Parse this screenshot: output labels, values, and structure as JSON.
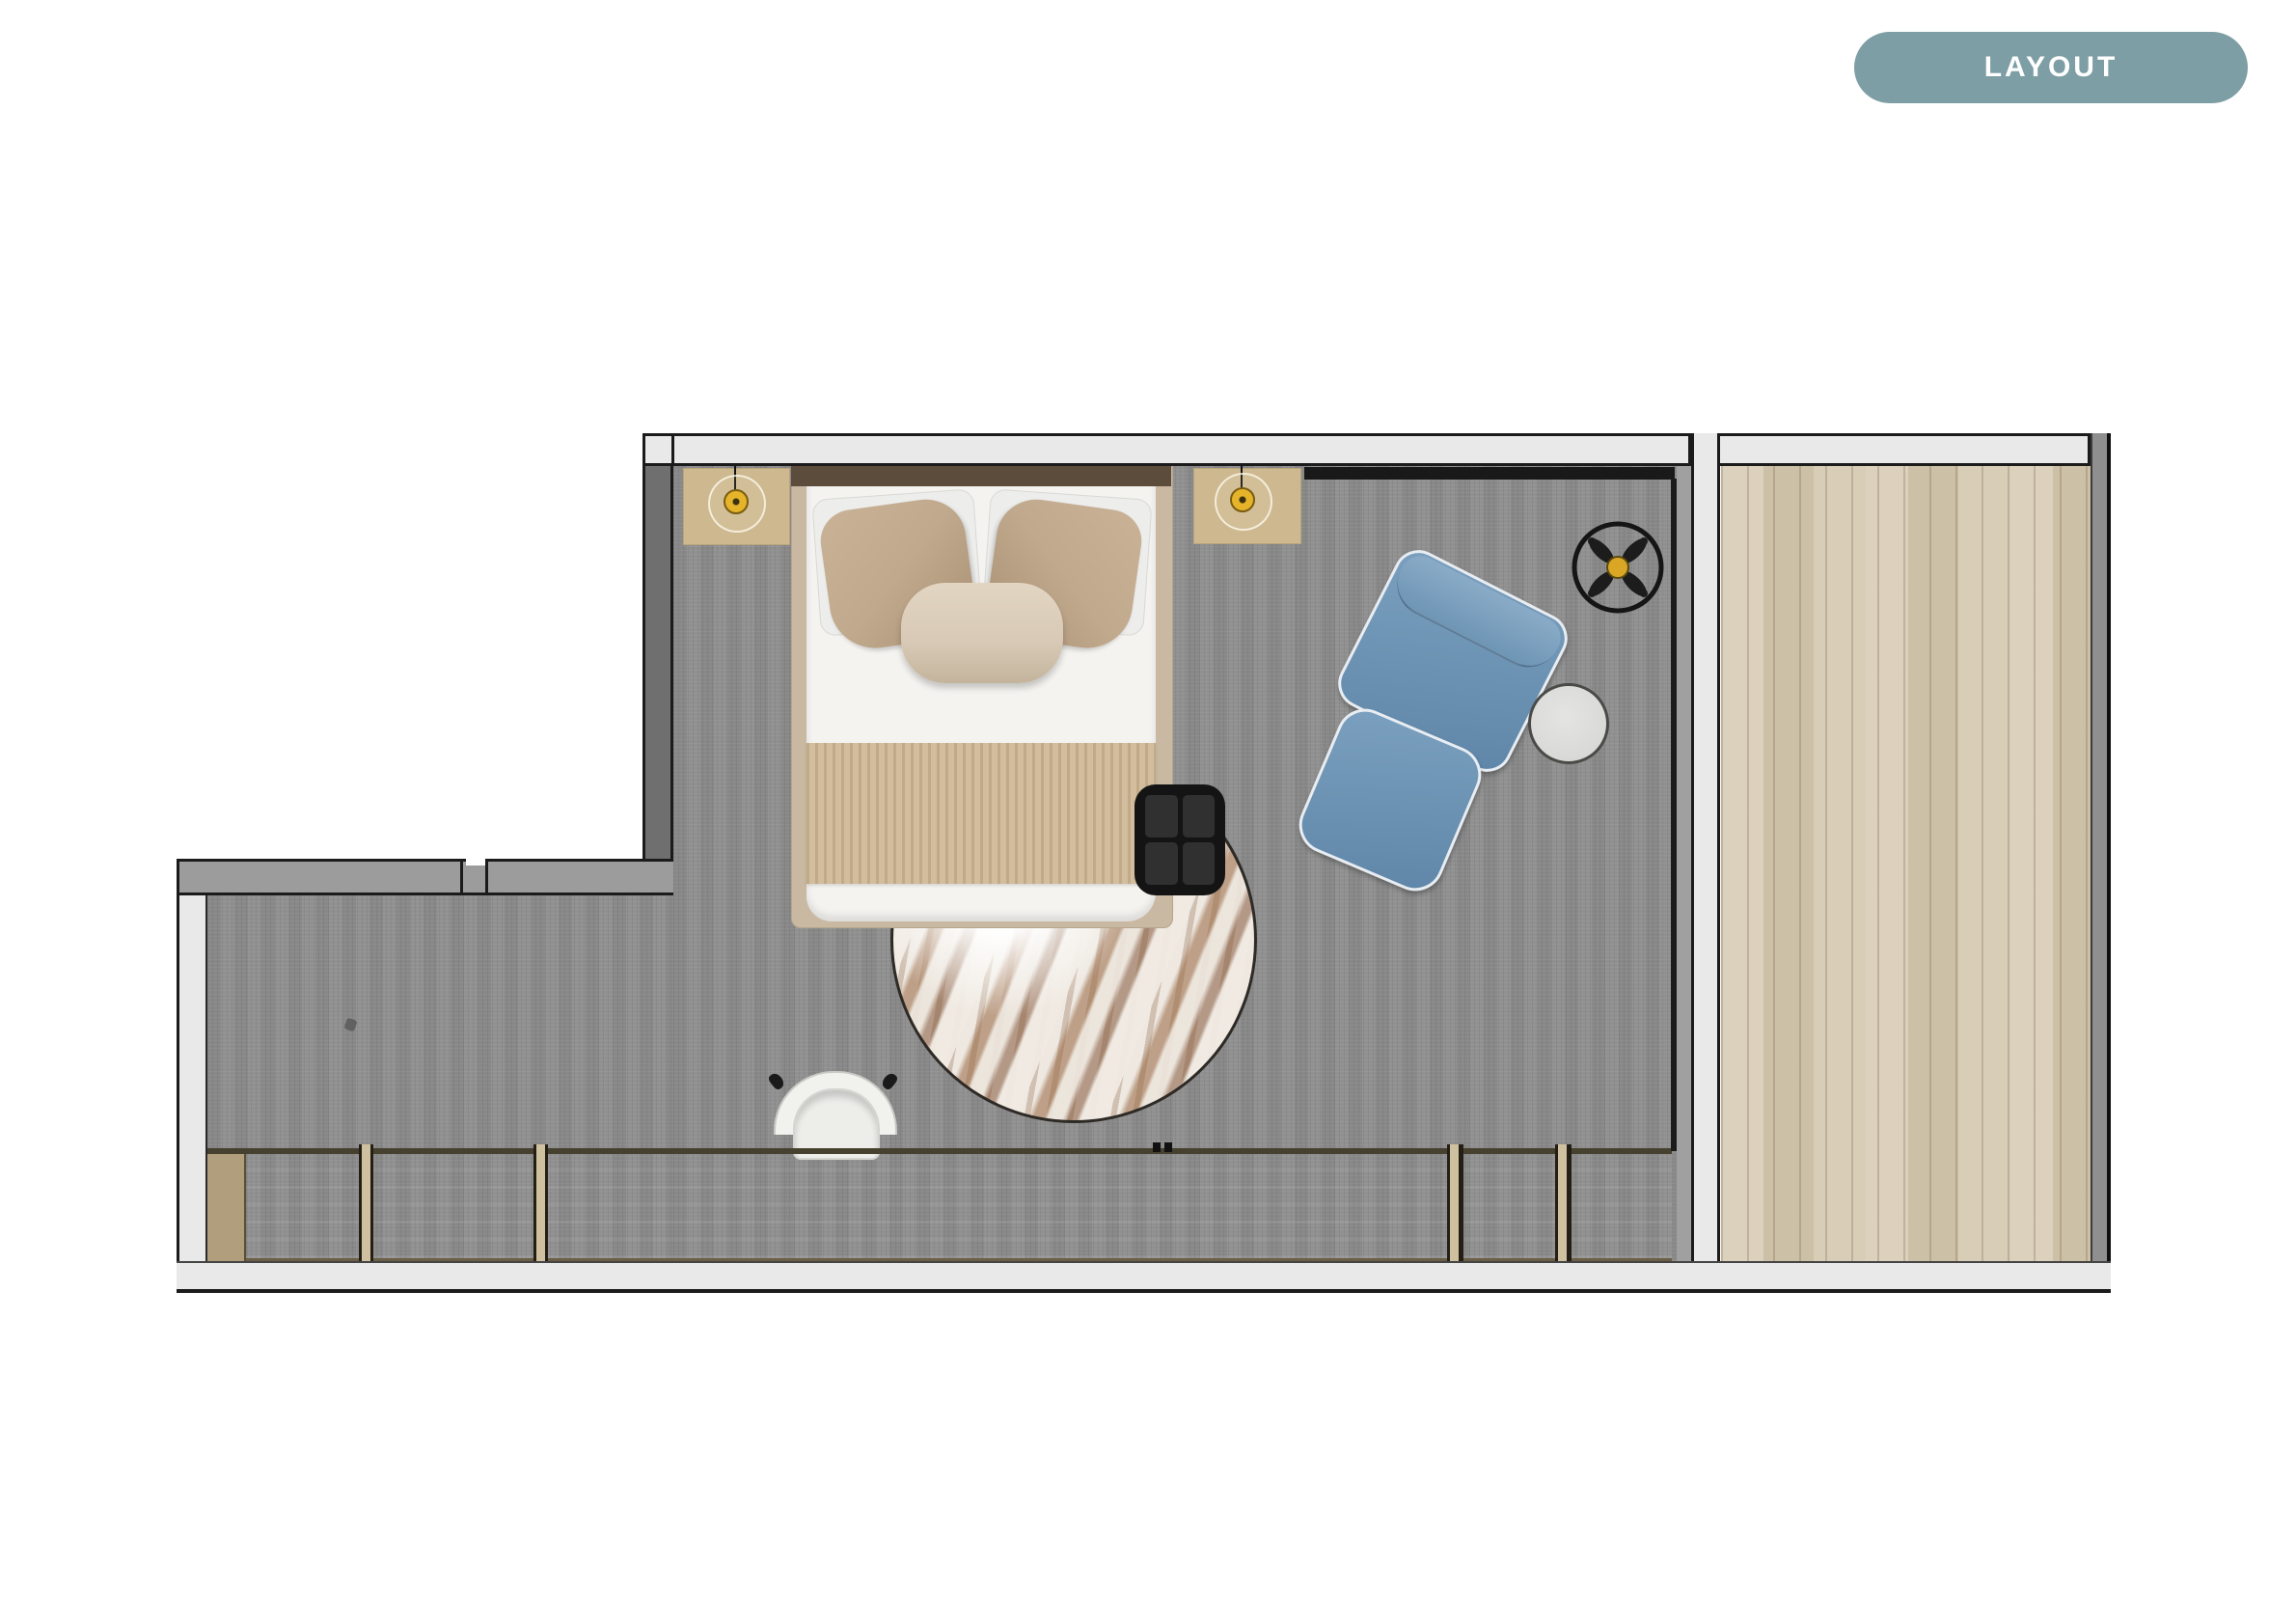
{
  "badge": {
    "label": "LAYOUT"
  },
  "colors": {
    "badge_bg": "#7d9ea4",
    "outline": "#1b1b1b",
    "wall_light": "#e9e9e9",
    "wall_mid": "#9c9c9c",
    "wall_dark": "#6f6f6f",
    "carpet": "#8d8d8d",
    "wood": "#d5cab2",
    "desk": "#b3a180",
    "nightstand": "#cdb88f",
    "bed_frame": "#c9b9a2",
    "headboard": "#5c4c3b",
    "pillow_tan": "#c0a98d",
    "bolster": "#d7c9b5",
    "throw": "#d2bd9d",
    "chair_blue": "#6c92b3",
    "side_table_gray": "#d9d9d7",
    "accent_yellow": "#e5b42a",
    "rug_rust": "#8a5f42"
  },
  "plan": {
    "rooms": [
      {
        "name": "bedroom",
        "floor": "carpet"
      },
      {
        "name": "balcony",
        "floor": "wood-planks"
      }
    ],
    "furniture": [
      "double-bed",
      "headboard",
      "white-pillows",
      "tan-pillows",
      "lumbar-bolster",
      "bed-throw",
      "nightstand-left",
      "nightstand-right",
      "pendant-light-left",
      "pendant-light-right",
      "ceiling-fan",
      "curtain-track",
      "lounge-chair",
      "ottoman",
      "round-side-table",
      "black-coffee-table",
      "round-area-rug",
      "built-in-desk",
      "desk-chair",
      "sliding-glass-window"
    ]
  }
}
